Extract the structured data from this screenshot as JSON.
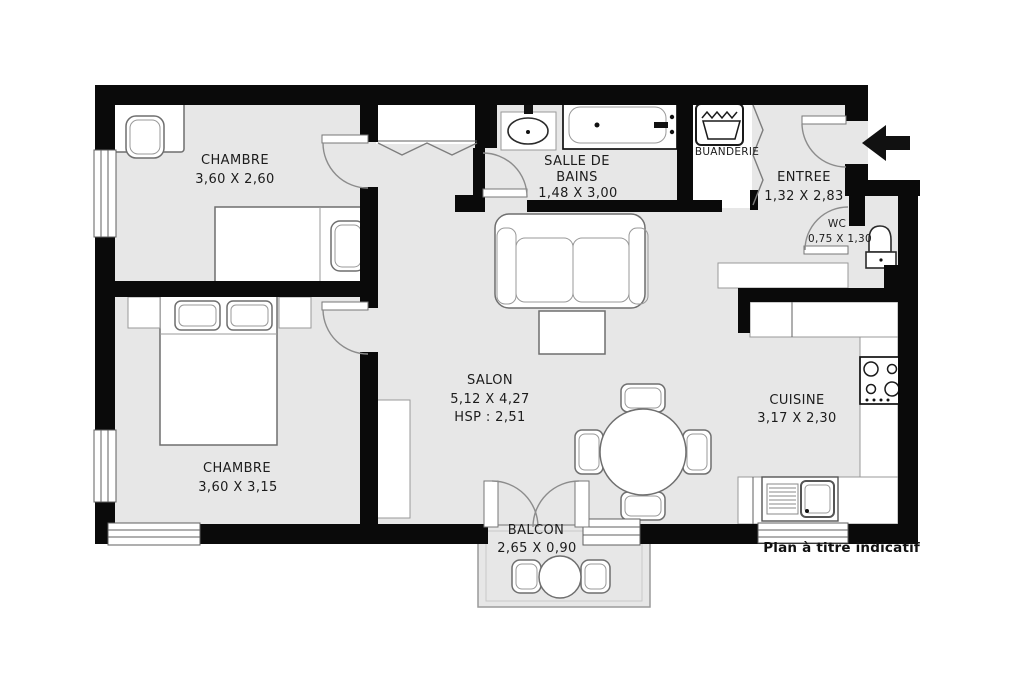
{
  "footer": {
    "note": "Plan à titre indicatif"
  },
  "rooms": {
    "chambre_haut": {
      "name": "CHAMBRE",
      "dims": "3,60 X 2,60"
    },
    "chambre_bas": {
      "name": "CHAMBRE",
      "dims": "3,60 X 3,15"
    },
    "salle_de_bains": {
      "line1": "SALLE DE",
      "line2": "BAINS",
      "dims": "1,48 X 3,00"
    },
    "buanderie": {
      "name": "BUANDERIE"
    },
    "entree": {
      "name": "ENTREE",
      "dims": "1,32 X 2,83"
    },
    "wc": {
      "name": "WC",
      "dims": "0,75 X 1,30"
    },
    "salon": {
      "name": "SALON",
      "dims": "5,12 X 4,27",
      "hsp": "HSP : 2,51"
    },
    "cuisine": {
      "name": "CUISINE",
      "dims": "3,17 X 2,30"
    },
    "balcon": {
      "name": "BALCON",
      "dims": "2,65 X 0,90"
    }
  },
  "colors": {
    "wall": "#0a0a0a",
    "floor": "#e7e7e7",
    "fixture": "#ffffff",
    "furniture_stroke": "#6f6f6f",
    "detail_line": "#999999",
    "text": "#1c1c1c",
    "accent_black": "#111111"
  }
}
